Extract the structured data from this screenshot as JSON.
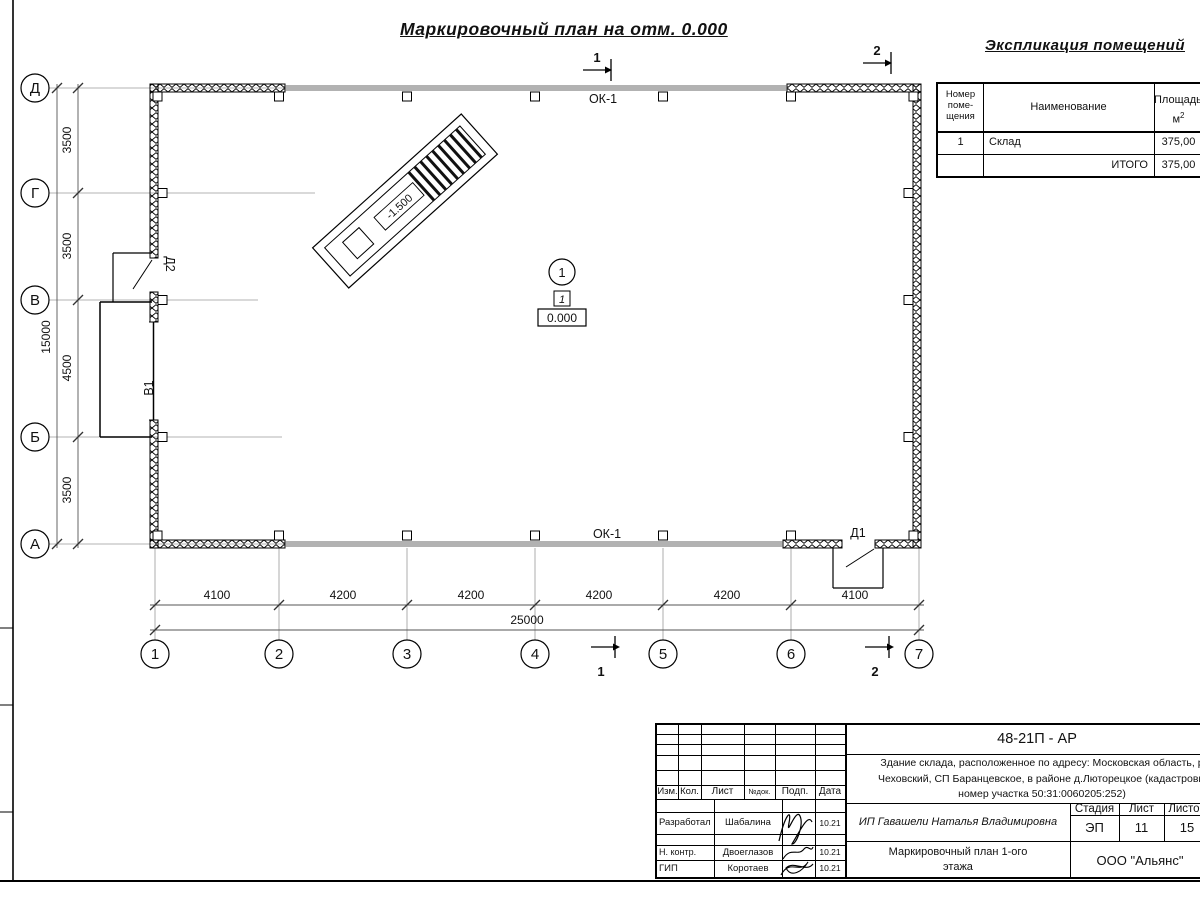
{
  "drawing": {
    "title": "Маркировочный план на отм. 0.000",
    "axes_letters": [
      "Д",
      "Г",
      "В",
      "Б",
      "А"
    ],
    "axes_numbers": [
      "1",
      "2",
      "3",
      "4",
      "5",
      "6",
      "7"
    ],
    "dims_bottom": [
      "4100",
      "4200",
      "4200",
      "4200",
      "4200",
      "4100"
    ],
    "dim_total_bottom": "25000",
    "dims_left": [
      "3500",
      "3500",
      "4500",
      "3500"
    ],
    "dim_total_left": "15000",
    "labels": {
      "ok1": "ОК-1",
      "d1": "Д1",
      "d2": "Д2",
      "v1": "В1",
      "ramp_elevation": "-1.500",
      "room_number": "1",
      "floor_type": "1",
      "elevation": "0.000",
      "section1": "1",
      "section2": "2"
    }
  },
  "explication": {
    "title": "Экспликация  помещений",
    "header": {
      "col1_line1": "Номер",
      "col1_line2": "поме-",
      "col1_line3": "щения",
      "col2": "Наименование",
      "col3_line1": "Площадь,",
      "col3_unit": "м",
      "col3_sup": "2"
    },
    "row1": {
      "num": "1",
      "name": "Склад",
      "area": "375,00"
    },
    "total": {
      "label": "ИТОГО",
      "area": "375,00"
    }
  },
  "titleblock": {
    "doc_number": "48-21П - АР",
    "description_line1": "Здание склада, расположенное по адресу: Московская область, р",
    "description_line2": "Чеховский, СП Баранцевское, в районе д.Люторецкое  (кадастровы",
    "description_line3": "номер участка 50:31:0060205:252)",
    "cols": {
      "izm": "Изм.",
      "kol": "Кол.",
      "list": "Лист",
      "ndok": "№док.",
      "podp": "Подп.",
      "data": "Дата"
    },
    "people": {
      "developed_label": "Разработал",
      "developed_name": "Шабалина",
      "developed_date": "10.21",
      "ncontr_label": "Н. контр.",
      "ncontr_name": "Двоеглазов",
      "ncontr_date": "10.21",
      "gip_label": "ГИП",
      "gip_name": "Коротаев",
      "gip_date": "10.21"
    },
    "client": "ИП Гавашели Наталья Владимировна",
    "stage_label": "Стадия",
    "sheet_label": "Лист",
    "sheets_label": "Листов",
    "stage": "ЭП",
    "sheet": "11",
    "sheets": "15",
    "plan_title_line1": "Маркировочный план 1-ого",
    "plan_title_line2": "этажа",
    "company": "ООО \"Альянс\""
  }
}
